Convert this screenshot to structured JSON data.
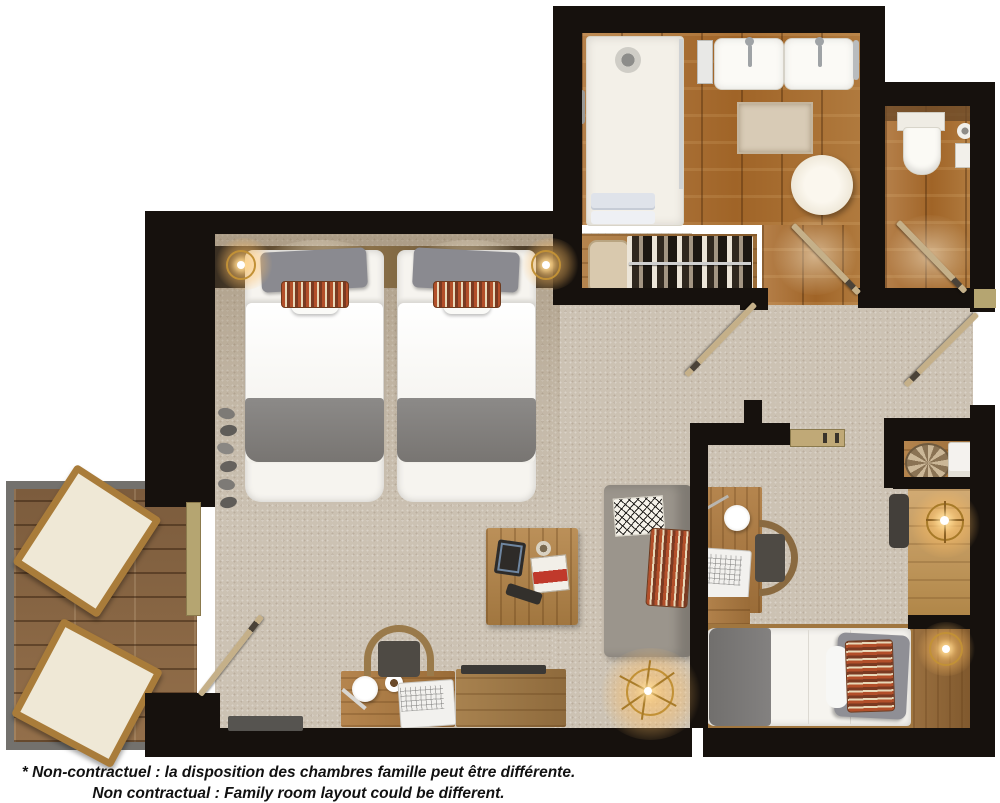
{
  "caption": {
    "line1": "* Non-contractuel : la disposition des chambres famille peut être différente.",
    "line2": "Non contractual : Family room layout could be different."
  },
  "palette": {
    "wall": "#16110d",
    "carpet": "#ccc2b3",
    "wood": "#ab7136",
    "wood-light": "#c9a368",
    "deck": "#8d6c49",
    "deck-border": "#73716d",
    "gold": "#c29136",
    "door": "#c5b089",
    "white": "#f6f4ef",
    "gray-fabric": "#8a8a8f",
    "throw": "#82807e",
    "sofa": "#9b958c",
    "orange": "#b34f2a",
    "ink": "#111111"
  }
}
